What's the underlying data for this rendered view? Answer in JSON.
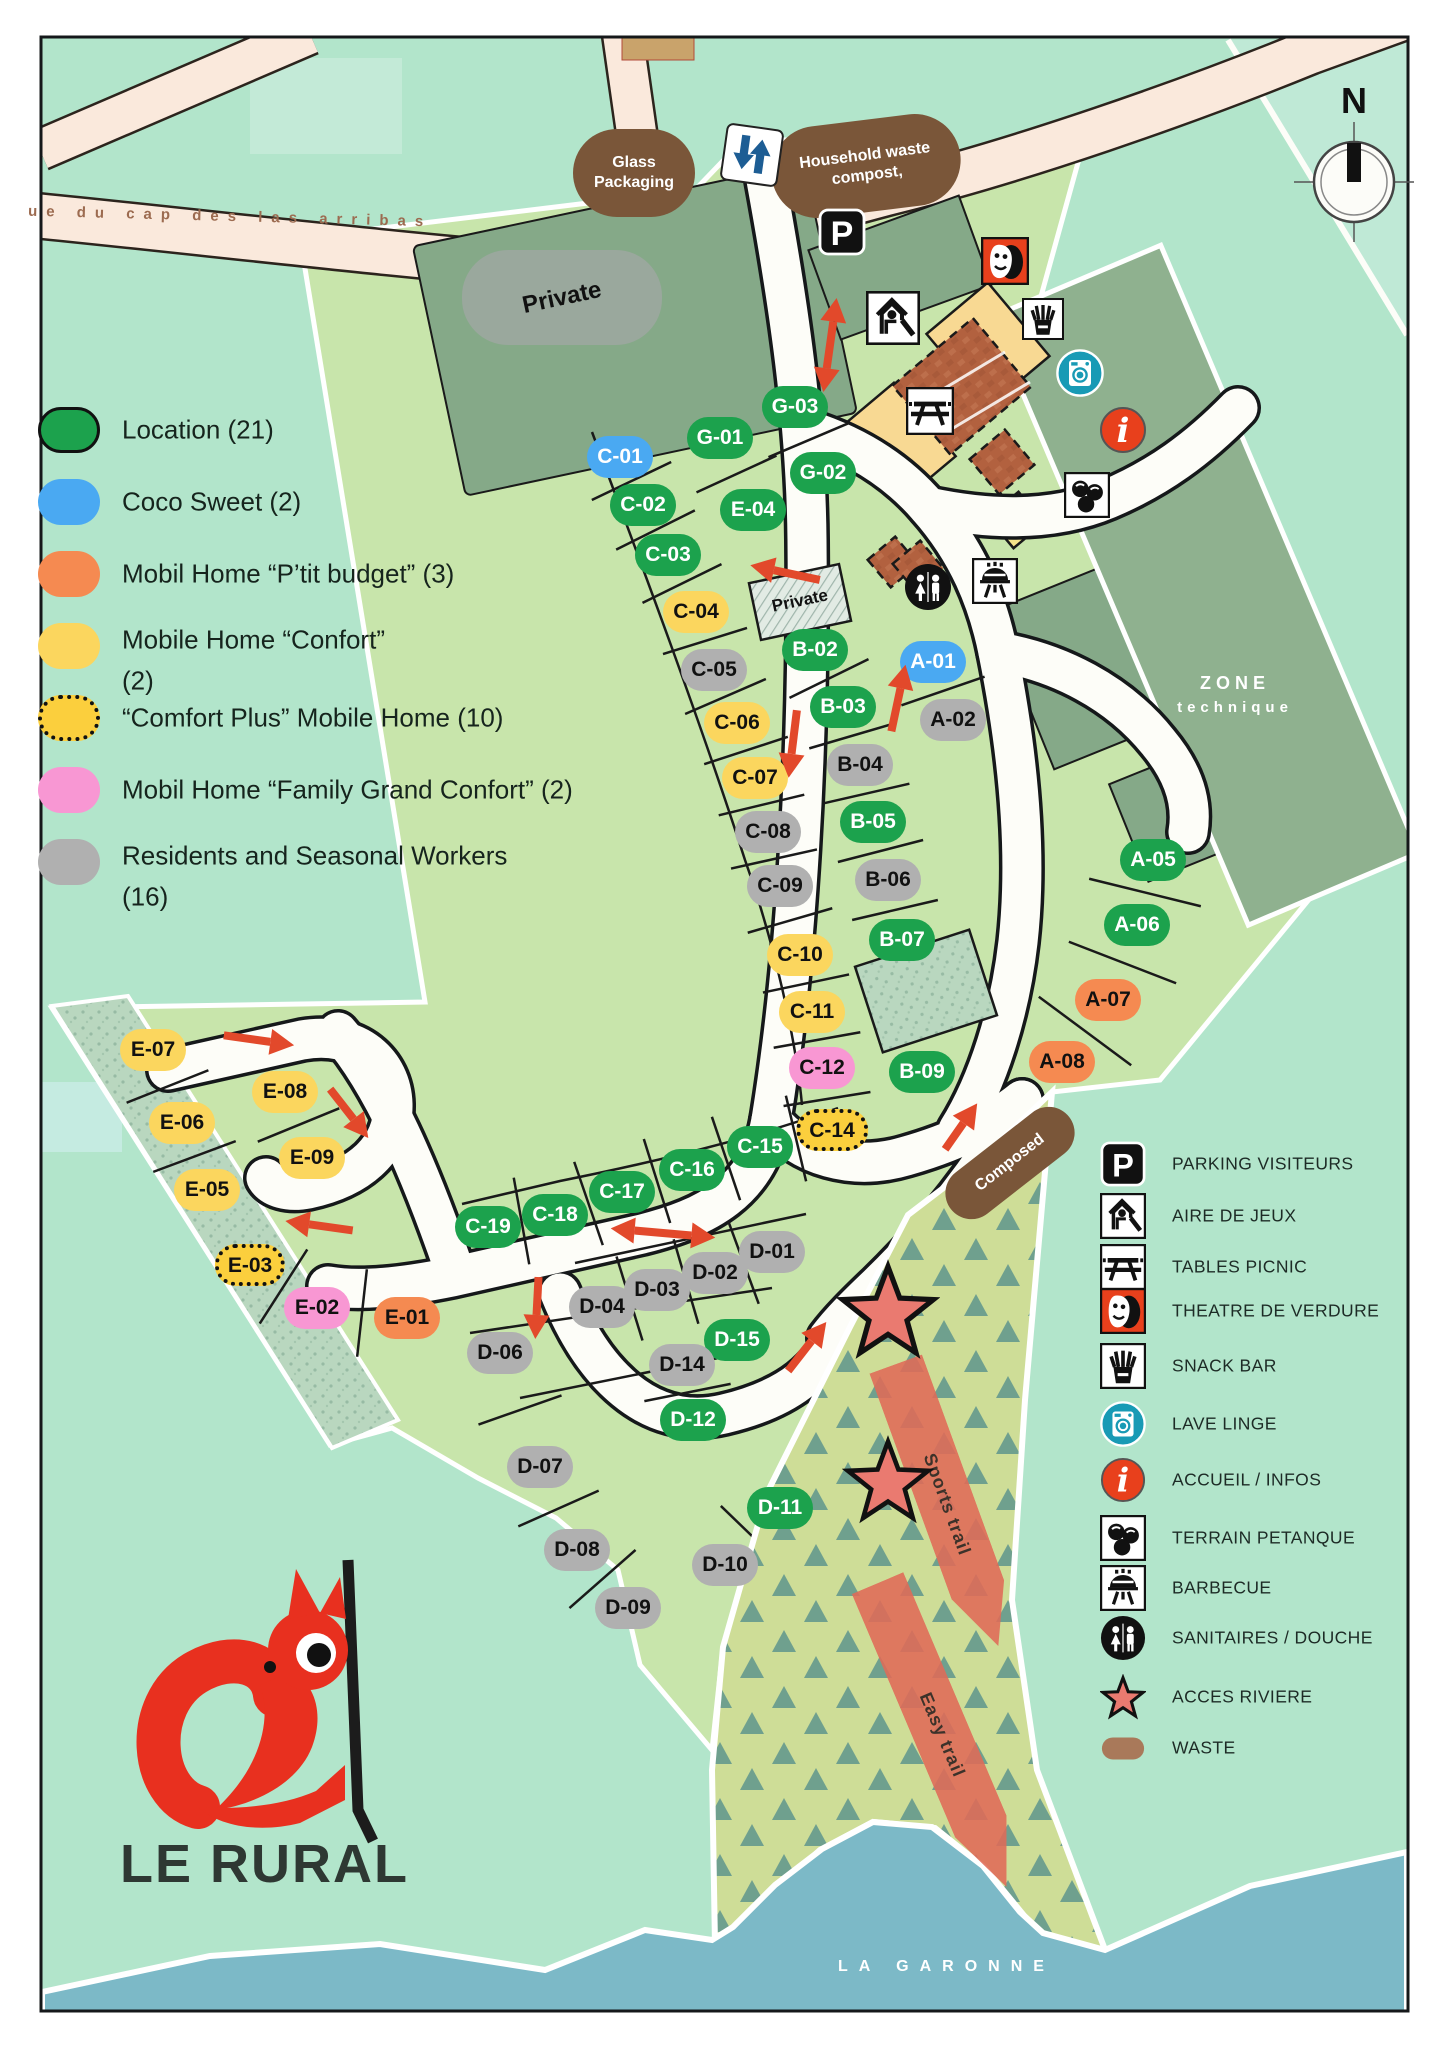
{
  "colors": {
    "location": "#1ca24d",
    "coco": "#4aa9f2",
    "budget": "#f58a51",
    "confort": "#fbd65e",
    "confortplus": "#fbcf3d",
    "family": "#f897d3",
    "resident": "#b0b0b0",
    "brown": "#7a5639",
    "accent_red": "#e2492b",
    "water": "#7cb9c7",
    "mint": "#b2e5cb",
    "campsite_green": "#c8e5ab",
    "sage": "#85a988"
  },
  "logo": {
    "text": "LE RURAL"
  },
  "compass": {
    "label": "N"
  },
  "street": {
    "name": "ue du cap des las arribas"
  },
  "river": {
    "name": "LA GARONNE"
  },
  "zone_technique": {
    "line1": "ZONE",
    "line2": "technique"
  },
  "private_area": {
    "label": "Private"
  },
  "private_parcel": {
    "label": "Private"
  },
  "signs": {
    "glass": {
      "line1": "Glass",
      "line2": "Packaging"
    },
    "household": {
      "line1": "Household waste",
      "line2": "compost,"
    },
    "composed": {
      "label": "Composed"
    }
  },
  "trails": [
    {
      "label": "Sports trail"
    },
    {
      "label": "Easy trail"
    }
  ],
  "legend_left": {
    "items": [
      {
        "type": "location",
        "label": "Location (21)"
      },
      {
        "type": "coco",
        "label": "Coco Sweet (2)"
      },
      {
        "type": "budget",
        "label": "Mobil Home  “P’tit budget” (3)"
      },
      {
        "type": "confort",
        "label": "Mobile Home “Confort”",
        "label2": "(2)"
      },
      {
        "type": "confortplus",
        "label": "“Comfort Plus” Mobile Home (10)"
      },
      {
        "type": "family",
        "label": "Mobil Home  “Family Grand Confort” (2)"
      },
      {
        "type": "resident",
        "label": "Residents and Seasonal Workers",
        "label2": "(16)"
      }
    ]
  },
  "legend_right": {
    "items": [
      {
        "icon": "parking",
        "label": "PARKING VISITEURS"
      },
      {
        "icon": "playground",
        "label": "AIRE DE JEUX"
      },
      {
        "icon": "picnic",
        "label": "TABLES PICNIC"
      },
      {
        "icon": "theatre",
        "label": "THEATRE DE VERDURE"
      },
      {
        "icon": "snack",
        "label": "SNACK BAR"
      },
      {
        "icon": "laundry",
        "label": "LAVE LINGE"
      },
      {
        "icon": "info",
        "label": "ACCUEIL /  INFOS"
      },
      {
        "icon": "petanque",
        "label": "TERRAIN PETANQUE"
      },
      {
        "icon": "barbecue",
        "label": "BARBECUE"
      },
      {
        "icon": "sanitaires",
        "label": "SANITAIRES  /  DOUCHE"
      },
      {
        "icon": "star",
        "label": "ACCES RIVIERE"
      },
      {
        "icon": "waste",
        "label": "WASTE"
      }
    ]
  },
  "plots": [
    {
      "id": "G-03",
      "type": "location",
      "x": 795,
      "y": 407
    },
    {
      "id": "G-01",
      "type": "location",
      "x": 720,
      "y": 438
    },
    {
      "id": "G-02",
      "type": "location",
      "x": 823,
      "y": 473
    },
    {
      "id": "E-04",
      "type": "location",
      "x": 753,
      "y": 510
    },
    {
      "id": "C-01",
      "type": "coco",
      "x": 620,
      "y": 457
    },
    {
      "id": "C-02",
      "type": "location",
      "x": 643,
      "y": 505
    },
    {
      "id": "C-03",
      "type": "location",
      "x": 668,
      "y": 555
    },
    {
      "id": "C-04",
      "type": "confort",
      "x": 696,
      "y": 612
    },
    {
      "id": "C-05",
      "type": "resident",
      "x": 714,
      "y": 670
    },
    {
      "id": "C-06",
      "type": "confort",
      "x": 737,
      "y": 723
    },
    {
      "id": "C-07",
      "type": "confort",
      "x": 755,
      "y": 778
    },
    {
      "id": "C-08",
      "type": "resident",
      "x": 768,
      "y": 832
    },
    {
      "id": "C-09",
      "type": "resident",
      "x": 780,
      "y": 886
    },
    {
      "id": "C-10",
      "type": "confort",
      "x": 800,
      "y": 955
    },
    {
      "id": "C-11",
      "type": "confort",
      "x": 812,
      "y": 1012
    },
    {
      "id": "C-12",
      "type": "family",
      "x": 822,
      "y": 1068
    },
    {
      "id": "C-14",
      "type": "confortplus",
      "x": 832,
      "y": 1130
    },
    {
      "id": "C-15",
      "type": "location",
      "x": 760,
      "y": 1147
    },
    {
      "id": "C-16",
      "type": "location",
      "x": 692,
      "y": 1170
    },
    {
      "id": "C-17",
      "type": "location",
      "x": 622,
      "y": 1192
    },
    {
      "id": "C-18",
      "type": "location",
      "x": 555,
      "y": 1215
    },
    {
      "id": "C-19",
      "type": "location",
      "x": 488,
      "y": 1227
    },
    {
      "id": "B-02",
      "type": "location",
      "x": 815,
      "y": 650
    },
    {
      "id": "B-03",
      "type": "location",
      "x": 843,
      "y": 707
    },
    {
      "id": "B-04",
      "type": "resident",
      "x": 860,
      "y": 765
    },
    {
      "id": "B-05",
      "type": "location",
      "x": 873,
      "y": 822
    },
    {
      "id": "B-06",
      "type": "resident",
      "x": 888,
      "y": 880
    },
    {
      "id": "B-07",
      "type": "location",
      "x": 902,
      "y": 940
    },
    {
      "id": "B-09",
      "type": "location",
      "x": 922,
      "y": 1072
    },
    {
      "id": "A-01",
      "type": "coco",
      "x": 933,
      "y": 662
    },
    {
      "id": "A-02",
      "type": "resident",
      "x": 953,
      "y": 720
    },
    {
      "id": "A-05",
      "type": "location",
      "x": 1153,
      "y": 860
    },
    {
      "id": "A-06",
      "type": "location",
      "x": 1137,
      "y": 925
    },
    {
      "id": "A-07",
      "type": "budget",
      "x": 1108,
      "y": 1000
    },
    {
      "id": "A-08",
      "type": "budget",
      "x": 1062,
      "y": 1062
    },
    {
      "id": "D-01",
      "type": "resident",
      "x": 772,
      "y": 1252
    },
    {
      "id": "D-02",
      "type": "resident",
      "x": 715,
      "y": 1273
    },
    {
      "id": "D-03",
      "type": "resident",
      "x": 657,
      "y": 1290
    },
    {
      "id": "D-04",
      "type": "resident",
      "x": 602,
      "y": 1307
    },
    {
      "id": "D-06",
      "type": "resident",
      "x": 500,
      "y": 1353
    },
    {
      "id": "D-15",
      "type": "location",
      "x": 737,
      "y": 1340
    },
    {
      "id": "D-14",
      "type": "resident",
      "x": 682,
      "y": 1365
    },
    {
      "id": "D-12",
      "type": "location",
      "x": 693,
      "y": 1420
    },
    {
      "id": "D-07",
      "type": "resident",
      "x": 540,
      "y": 1467
    },
    {
      "id": "D-11",
      "type": "location",
      "x": 780,
      "y": 1508
    },
    {
      "id": "D-08",
      "type": "resident",
      "x": 577,
      "y": 1550
    },
    {
      "id": "D-10",
      "type": "resident",
      "x": 725,
      "y": 1565
    },
    {
      "id": "D-09",
      "type": "resident",
      "x": 628,
      "y": 1608
    },
    {
      "id": "E-07",
      "type": "confort",
      "x": 153,
      "y": 1050
    },
    {
      "id": "E-08",
      "type": "confort",
      "x": 285,
      "y": 1092
    },
    {
      "id": "E-06",
      "type": "confort",
      "x": 182,
      "y": 1123
    },
    {
      "id": "E-09",
      "type": "confort",
      "x": 312,
      "y": 1158
    },
    {
      "id": "E-05",
      "type": "confort",
      "x": 207,
      "y": 1190
    },
    {
      "id": "E-03",
      "type": "confortplus",
      "x": 250,
      "y": 1265
    },
    {
      "id": "E-02",
      "type": "family",
      "x": 317,
      "y": 1308
    },
    {
      "id": "E-01",
      "type": "budget",
      "x": 407,
      "y": 1318
    }
  ],
  "map_icons": [
    {
      "icon": "parking",
      "x": 842,
      "y": 232,
      "size": 48
    },
    {
      "icon": "playground",
      "x": 893,
      "y": 318,
      "size": 54
    },
    {
      "icon": "theatre",
      "x": 1005,
      "y": 261,
      "size": 48
    },
    {
      "icon": "snack",
      "x": 1043,
      "y": 319,
      "size": 42
    },
    {
      "icon": "picnic",
      "x": 930,
      "y": 411,
      "size": 48
    },
    {
      "icon": "laundry",
      "x": 1080,
      "y": 373,
      "size": 48
    },
    {
      "icon": "info",
      "x": 1123,
      "y": 430,
      "size": 48
    },
    {
      "icon": "petanque",
      "x": 1087,
      "y": 495,
      "size": 46
    },
    {
      "icon": "sanitaires",
      "x": 928,
      "y": 587,
      "size": 48
    },
    {
      "icon": "barbecue",
      "x": 995,
      "y": 581,
      "size": 46
    }
  ],
  "stars": [
    {
      "x": 888,
      "y": 1310,
      "r": 52
    },
    {
      "x": 888,
      "y": 1480,
      "r": 46
    }
  ],
  "arrows": [
    {
      "x": 830,
      "y": 345,
      "rot": 98,
      "len": 95,
      "double": true
    },
    {
      "x": 787,
      "y": 573,
      "rot": 192,
      "len": 75,
      "double": false
    },
    {
      "x": 793,
      "y": 742,
      "rot": 97,
      "len": 72,
      "double": false
    },
    {
      "x": 898,
      "y": 700,
      "rot": -78,
      "len": 72,
      "double": false
    },
    {
      "x": 257,
      "y": 1040,
      "rot": 8,
      "len": 75,
      "double": false
    },
    {
      "x": 348,
      "y": 1112,
      "rot": 52,
      "len": 66,
      "double": false
    },
    {
      "x": 321,
      "y": 1226,
      "rot": 188,
      "len": 72,
      "double": false
    },
    {
      "x": 663,
      "y": 1233,
      "rot": 5,
      "len": 105,
      "double": true
    },
    {
      "x": 537,
      "y": 1306,
      "rot": 93,
      "len": 66,
      "double": false
    },
    {
      "x": 806,
      "y": 1348,
      "rot": -52,
      "len": 66,
      "double": false
    },
    {
      "x": 960,
      "y": 1128,
      "rot": -55,
      "len": 60,
      "double": false
    }
  ]
}
